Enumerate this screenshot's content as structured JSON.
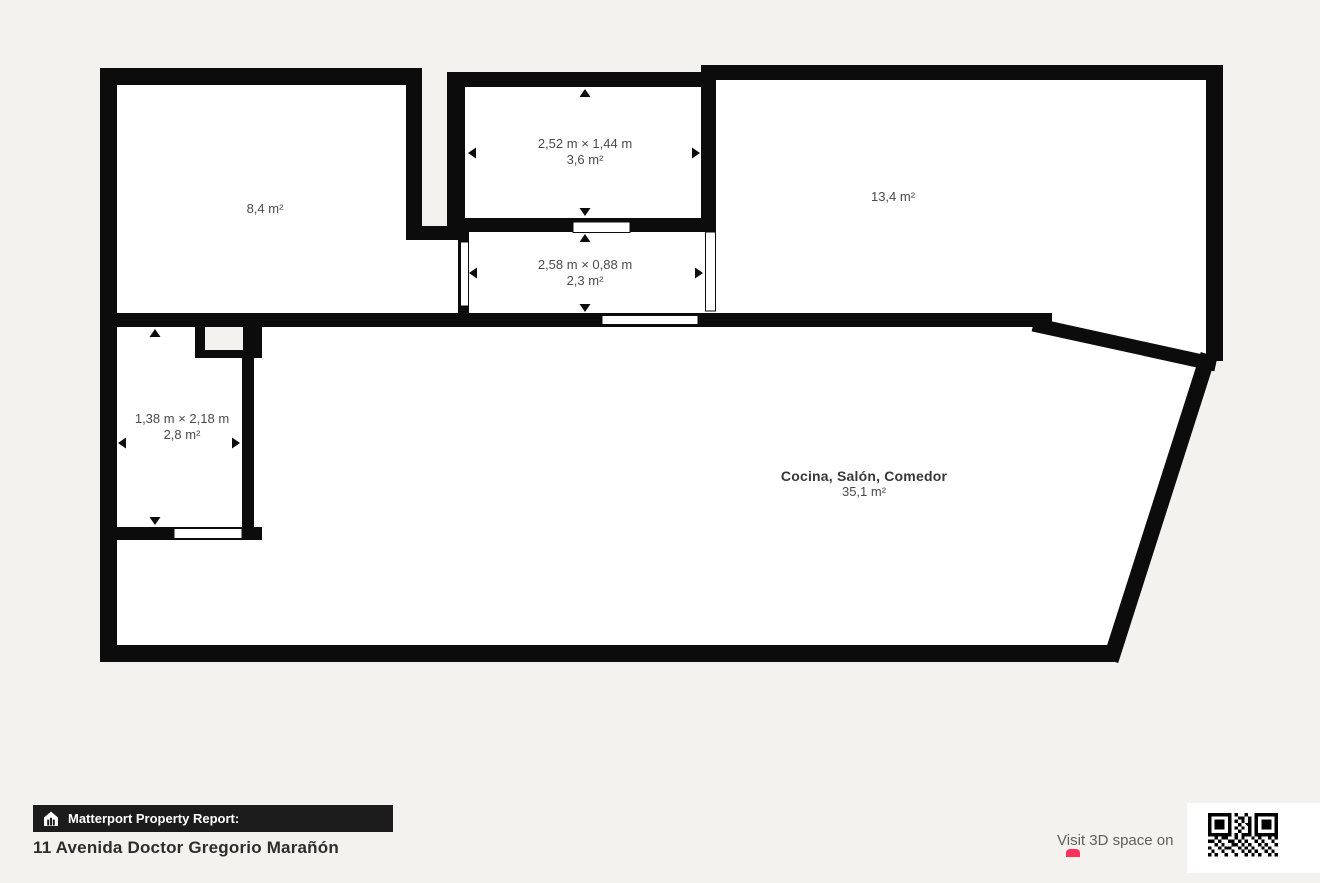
{
  "floorplan": {
    "rooms": [
      {
        "id": "room-top-left",
        "area": "8,4 m²"
      },
      {
        "id": "room-top-middle",
        "dimensions": "2,52 m × 1,44 m",
        "area": "3,6 m²"
      },
      {
        "id": "room-top-right",
        "area": "13,4 m²"
      },
      {
        "id": "hallway",
        "dimensions": "2,58 m × 0,88 m",
        "area": "2,3 m²"
      },
      {
        "id": "room-small-left",
        "dimensions": "1,38 m × 2,18 m",
        "area": "2,8 m²"
      },
      {
        "id": "main-living-room",
        "name": "Cocina, Salón, Comedor",
        "area": "35,1 m²"
      }
    ]
  },
  "footer": {
    "badge_label": "Matterport Property Report:",
    "address": "11 Avenida Doctor Gregorio Marañón",
    "visit_3d_text": "Visit 3D space on"
  },
  "colors": {
    "background": "#f4f2ef",
    "wall": "#0c0c0c",
    "floor": "#ffffff",
    "label_text": "#4a4a4a",
    "room_name_text": "#383838",
    "badge_bg": "#1c1c1c",
    "badge_text": "#ffffff",
    "accent_red": "#ff3158"
  }
}
